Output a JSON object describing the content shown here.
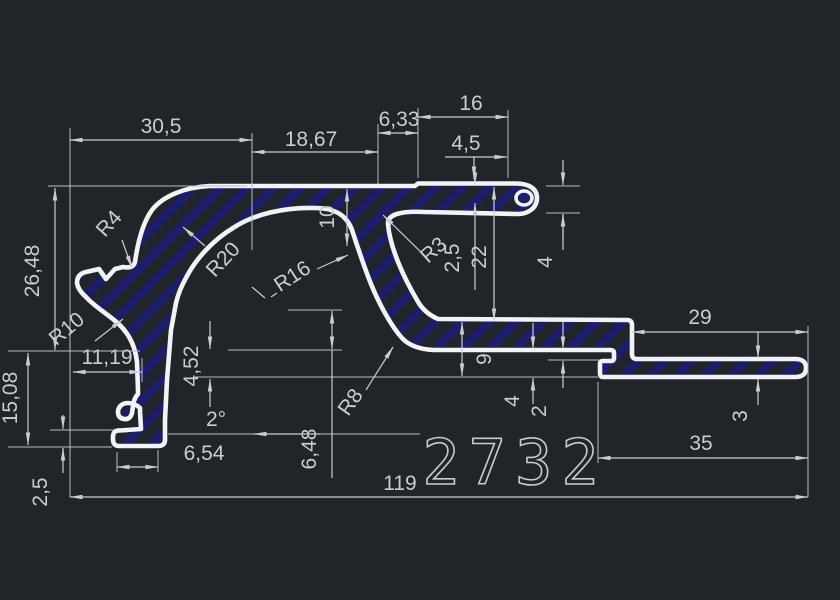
{
  "drawing": {
    "part_number": "2732",
    "colors": {
      "background": "#212429",
      "outline": "#f2f3f5",
      "hatch": "#1b1d6e",
      "dimension": "#c9ccd2"
    },
    "dims": {
      "w30_5": "30,5",
      "w18_67": "18,67",
      "w6_33": "6,33",
      "w16": "16",
      "w4_5": "4,5",
      "h4_top": "4",
      "h2_5_top": "2,5",
      "h22": "22",
      "h10": "10",
      "h26_48": "26,48",
      "h15_08": "15,08",
      "w11_19": "11,19",
      "h2_5_foot": "2,5",
      "w6_54": "6,54",
      "angle_2": "2°",
      "h4_52": "4,52",
      "h6_48": "6,48",
      "h9": "9",
      "h4_mid": "4",
      "h2": "2",
      "w29": "29",
      "h3": "3",
      "w35": "35",
      "w119": "119"
    },
    "radii": {
      "r4": "R4",
      "r20": "R20",
      "r16": "R16",
      "r10": "R10",
      "r3": "R3",
      "r8": "R8"
    }
  }
}
